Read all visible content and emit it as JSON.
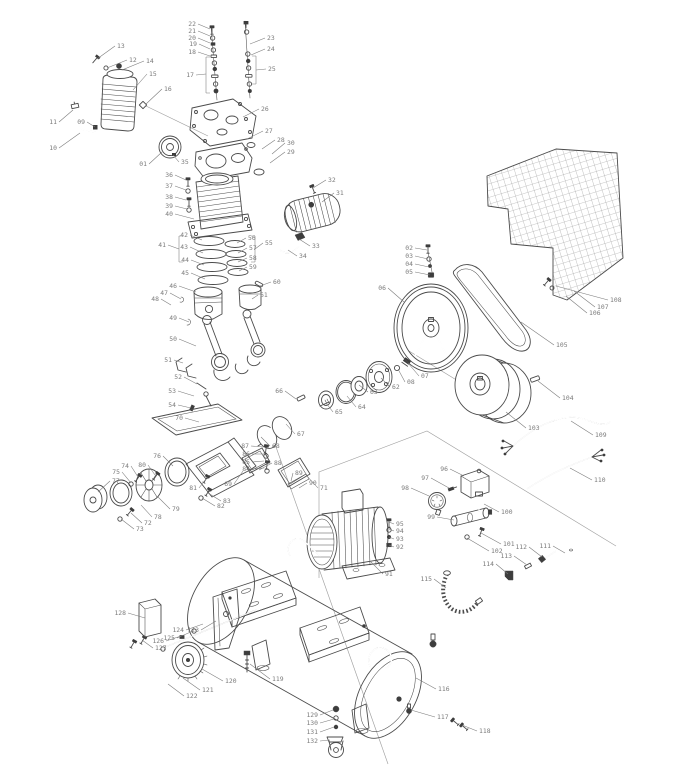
{
  "canvas": {
    "width": 686,
    "height": 768
  },
  "diagram": {
    "type": "exploded-parts-diagram",
    "colors": {
      "line": "#4b4b4b",
      "label": "#7a7a7a",
      "construction": "#a0a0a0",
      "dark": "#3d3d3d",
      "background": "#ffffff"
    },
    "callouts": [
      {
        "n": "01",
        "lx": 147,
        "ly": 164,
        "tx": 162,
        "ty": 152
      },
      {
        "n": "02",
        "lx": 413,
        "ly": 248,
        "tx": 427,
        "ty": 250
      },
      {
        "n": "03",
        "lx": 413,
        "ly": 256,
        "tx": 428,
        "ty": 259
      },
      {
        "n": "04",
        "lx": 413,
        "ly": 264,
        "tx": 429,
        "ty": 267
      },
      {
        "n": "05",
        "lx": 413,
        "ly": 272,
        "tx": 430,
        "ty": 275
      },
      {
        "n": "06",
        "lx": 386,
        "ly": 288,
        "tx": 404,
        "ty": 302
      },
      {
        "n": "07",
        "lx": 421,
        "ly": 376,
        "tx": 408,
        "ty": 363
      },
      {
        "n": "08",
        "lx": 407,
        "ly": 382,
        "tx": 398,
        "ty": 369
      },
      {
        "n": "09",
        "lx": 85,
        "ly": 122,
        "tx": 95,
        "ty": 127
      },
      {
        "n": "10",
        "lx": 57,
        "ly": 148,
        "tx": 80,
        "ty": 133
      },
      {
        "n": "11",
        "lx": 57,
        "ly": 122,
        "tx": 73,
        "ty": 110
      },
      {
        "n": "12",
        "lx": 129,
        "ly": 60,
        "tx": 107,
        "ty": 68
      },
      {
        "n": "13",
        "lx": 117,
        "ly": 46,
        "tx": 97,
        "ty": 59
      },
      {
        "n": "14",
        "lx": 146,
        "ly": 61,
        "tx": 122,
        "ty": 70
      },
      {
        "n": "15",
        "lx": 149,
        "ly": 74,
        "tx": 133,
        "ty": 90
      },
      {
        "n": "16",
        "lx": 164,
        "ly": 89,
        "tx": 146,
        "ty": 104
      },
      {
        "n": "17",
        "lx": 194,
        "ly": 75,
        "tx": 206,
        "ty": 74
      },
      {
        "n": "18",
        "lx": 196,
        "ly": 52,
        "tx": 210,
        "ty": 56
      },
      {
        "n": "19",
        "lx": 197,
        "ly": 44,
        "tx": 210,
        "ty": 49
      },
      {
        "n": "20",
        "lx": 196,
        "ly": 38,
        "tx": 210,
        "ty": 43
      },
      {
        "n": "21",
        "lx": 196,
        "ly": 31,
        "tx": 210,
        "ty": 36
      },
      {
        "n": "22",
        "lx": 196,
        "ly": 24,
        "tx": 210,
        "ty": 29
      },
      {
        "n": "23",
        "lx": 267,
        "ly": 38,
        "tx": 250,
        "ty": 44
      },
      {
        "n": "24",
        "lx": 267,
        "ly": 49,
        "tx": 251,
        "ty": 55
      },
      {
        "n": "25",
        "lx": 268,
        "ly": 69,
        "tx": 256,
        "ty": 70
      },
      {
        "n": "26",
        "lx": 261,
        "ly": 109,
        "tx": 243,
        "ty": 117
      },
      {
        "n": "27",
        "lx": 265,
        "ly": 131,
        "tx": 247,
        "ty": 139
      },
      {
        "n": "28",
        "lx": 277,
        "ly": 140,
        "tx": 262,
        "ty": 149
      },
      {
        "n": "29",
        "lx": 287,
        "ly": 152,
        "tx": 270,
        "ty": 163
      },
      {
        "n": "30",
        "lx": 287,
        "ly": 143,
        "tx": 272,
        "ty": 154
      },
      {
        "n": "31",
        "lx": 336,
        "ly": 193,
        "tx": 322,
        "ty": 202
      },
      {
        "n": "32",
        "lx": 328,
        "ly": 180,
        "tx": 313,
        "ty": 188
      },
      {
        "n": "33",
        "lx": 312,
        "ly": 246,
        "tx": 299,
        "ty": 239
      },
      {
        "n": "34",
        "lx": 299,
        "ly": 256,
        "tx": 288,
        "ty": 250
      },
      {
        "n": "35",
        "lx": 181,
        "ly": 162,
        "tx": 173,
        "ty": 155
      },
      {
        "n": "36",
        "lx": 173,
        "ly": 175,
        "tx": 186,
        "ty": 180
      },
      {
        "n": "37",
        "lx": 173,
        "ly": 186,
        "tx": 186,
        "ty": 190
      },
      {
        "n": "38",
        "lx": 173,
        "ly": 197,
        "tx": 186,
        "ty": 200
      },
      {
        "n": "39",
        "lx": 173,
        "ly": 206,
        "tx": 187,
        "ty": 209
      },
      {
        "n": "40",
        "lx": 173,
        "ly": 214,
        "tx": 194,
        "ty": 219
      },
      {
        "n": "41",
        "lx": 166,
        "ly": 245,
        "tx": 179,
        "ty": 249
      },
      {
        "n": "42",
        "lx": 188,
        "ly": 235,
        "tx": 202,
        "ty": 240
      },
      {
        "n": "43",
        "lx": 188,
        "ly": 247,
        "tx": 203,
        "ty": 253
      },
      {
        "n": "44",
        "lx": 189,
        "ly": 260,
        "tx": 204,
        "ty": 265
      },
      {
        "n": "45",
        "lx": 189,
        "ly": 273,
        "tx": 205,
        "ty": 279
      },
      {
        "n": "46",
        "lx": 177,
        "ly": 286,
        "tx": 196,
        "ty": 292
      },
      {
        "n": "47",
        "lx": 168,
        "ly": 293,
        "tx": 181,
        "ty": 299
      },
      {
        "n": "48",
        "lx": 159,
        "ly": 299,
        "tx": 171,
        "ty": 305
      },
      {
        "n": "49",
        "lx": 177,
        "ly": 318,
        "tx": 189,
        "ty": 322
      },
      {
        "n": "50",
        "lx": 177,
        "ly": 339,
        "tx": 196,
        "ty": 346
      },
      {
        "n": "51",
        "lx": 172,
        "ly": 360,
        "tx": 183,
        "ty": 363
      },
      {
        "n": "52",
        "lx": 182,
        "ly": 377,
        "tx": 197,
        "ty": 384
      },
      {
        "n": "53",
        "lx": 176,
        "ly": 391,
        "tx": 194,
        "ty": 396
      },
      {
        "n": "54",
        "lx": 176,
        "ly": 405,
        "tx": 191,
        "ty": 408
      },
      {
        "n": "55",
        "lx": 265,
        "ly": 243,
        "tx": 255,
        "ty": 249
      },
      {
        "n": "56",
        "lx": 248,
        "ly": 238,
        "tx": 237,
        "ty": 243
      },
      {
        "n": "57",
        "lx": 249,
        "ly": 248,
        "tx": 238,
        "ty": 253
      },
      {
        "n": "58",
        "lx": 249,
        "ly": 258,
        "tx": 238,
        "ty": 262
      },
      {
        "n": "59",
        "lx": 249,
        "ly": 267,
        "tx": 239,
        "ty": 271
      },
      {
        "n": "60",
        "lx": 273,
        "ly": 282,
        "tx": 260,
        "ty": 286
      },
      {
        "n": "61",
        "lx": 260,
        "ly": 295,
        "tx": 252,
        "ty": 299
      },
      {
        "n": "62",
        "lx": 392,
        "ly": 387,
        "tx": 381,
        "ty": 378
      },
      {
        "n": "63",
        "lx": 370,
        "ly": 392,
        "tx": 359,
        "ty": 385
      },
      {
        "n": "64",
        "lx": 358,
        "ly": 407,
        "tx": 347,
        "ty": 396
      },
      {
        "n": "65",
        "lx": 335,
        "ly": 412,
        "tx": 326,
        "ty": 403
      },
      {
        "n": "66",
        "lx": 283,
        "ly": 391,
        "tx": 296,
        "ty": 399
      },
      {
        "n": "67",
        "lx": 297,
        "ly": 434,
        "tx": 286,
        "ty": 424
      },
      {
        "n": "68",
        "lx": 272,
        "ly": 446,
        "tx": 261,
        "ty": 437
      },
      {
        "n": "69",
        "lx": 232,
        "ly": 484,
        "tx": 243,
        "ty": 471
      },
      {
        "n": "70",
        "lx": 183,
        "ly": 418,
        "tx": 199,
        "ty": 422
      },
      {
        "n": "71",
        "lx": 320,
        "ly": 488,
        "tx": 306,
        "ty": 475
      },
      {
        "n": "72",
        "lx": 144,
        "ly": 523,
        "tx": 131,
        "ty": 513
      },
      {
        "n": "73",
        "lx": 136,
        "ly": 529,
        "tx": 121,
        "ty": 519
      },
      {
        "n": "74",
        "lx": 129,
        "ly": 466,
        "tx": 138,
        "ty": 477
      },
      {
        "n": "75",
        "lx": 120,
        "ly": 472,
        "tx": 131,
        "ty": 483
      },
      {
        "n": "76",
        "lx": 161,
        "ly": 456,
        "tx": 173,
        "ty": 466
      },
      {
        "n": "77",
        "lx": 112,
        "ly": 481,
        "tx": 98,
        "ty": 492
      },
      {
        "n": "78",
        "lx": 154,
        "ly": 517,
        "tx": 141,
        "ty": 505
      },
      {
        "n": "79",
        "lx": 172,
        "ly": 509,
        "tx": 158,
        "ty": 497
      },
      {
        "n": "80",
        "lx": 146,
        "ly": 465,
        "tx": 155,
        "ty": 475
      },
      {
        "n": "81",
        "lx": 197,
        "ly": 488,
        "tx": 206,
        "ty": 479
      },
      {
        "n": "82",
        "lx": 217,
        "ly": 506,
        "tx": 202,
        "ty": 498
      },
      {
        "n": "83",
        "lx": 223,
        "ly": 501,
        "tx": 208,
        "ty": 493
      },
      {
        "n": "84",
        "lx": 250,
        "ly": 469,
        "tx": 264,
        "ty": 468
      },
      {
        "n": "85",
        "lx": 250,
        "ly": 462,
        "tx": 264,
        "ty": 461
      },
      {
        "n": "86",
        "lx": 250,
        "ly": 454,
        "tx": 264,
        "ty": 454
      },
      {
        "n": "87",
        "lx": 249,
        "ly": 446,
        "tx": 264,
        "ty": 447
      },
      {
        "n": "88",
        "lx": 274,
        "ly": 463,
        "tx": 259,
        "ty": 470
      },
      {
        "n": "89",
        "lx": 295,
        "ly": 473,
        "tx": 291,
        "ty": 481
      },
      {
        "n": "90",
        "lx": 309,
        "ly": 483,
        "tx": 299,
        "ty": 488
      },
      {
        "n": "91",
        "lx": 385,
        "ly": 574,
        "tx": 371,
        "ty": 562
      },
      {
        "n": "92",
        "lx": 396,
        "ly": 547,
        "tx": 389,
        "ty": 545
      },
      {
        "n": "93",
        "lx": 396,
        "ly": 539,
        "tx": 389,
        "ty": 537
      },
      {
        "n": "94",
        "lx": 396,
        "ly": 531,
        "tx": 389,
        "ty": 529
      },
      {
        "n": "95",
        "lx": 396,
        "ly": 524,
        "tx": 389,
        "ty": 522
      },
      {
        "n": "96",
        "lx": 448,
        "ly": 469,
        "tx": 464,
        "ty": 476
      },
      {
        "n": "97",
        "lx": 429,
        "ly": 478,
        "tx": 449,
        "ty": 488
      },
      {
        "n": "98",
        "lx": 409,
        "ly": 488,
        "tx": 429,
        "ty": 496
      },
      {
        "n": "99",
        "lx": 435,
        "ly": 517,
        "tx": 454,
        "ty": 520
      },
      {
        "n": "100",
        "lx": 501,
        "ly": 512,
        "tx": 484,
        "ty": 504
      },
      {
        "n": "101",
        "lx": 503,
        "ly": 544,
        "tx": 481,
        "ty": 533
      },
      {
        "n": "102",
        "lx": 491,
        "ly": 551,
        "tx": 467,
        "ty": 538
      },
      {
        "n": "103",
        "lx": 528,
        "ly": 428,
        "tx": 506,
        "ty": 412
      },
      {
        "n": "104",
        "lx": 562,
        "ly": 398,
        "tx": 538,
        "ty": 381
      },
      {
        "n": "105",
        "lx": 556,
        "ly": 345,
        "tx": 521,
        "ty": 322
      },
      {
        "n": "106",
        "lx": 589,
        "ly": 313,
        "tx": 566,
        "ty": 296
      },
      {
        "n": "107",
        "lx": 597,
        "ly": 307,
        "tx": 574,
        "ty": 291
      },
      {
        "n": "108",
        "lx": 610,
        "ly": 300,
        "tx": 556,
        "ty": 286
      },
      {
        "n": "109",
        "lx": 595,
        "ly": 435,
        "tx": 571,
        "ty": 421
      },
      {
        "n": "110",
        "lx": 594,
        "ly": 480,
        "tx": 570,
        "ty": 468
      },
      {
        "n": "111",
        "lx": 551,
        "ly": 546,
        "tx": 565,
        "ty": 553
      },
      {
        "n": "112",
        "lx": 527,
        "ly": 547,
        "tx": 542,
        "ty": 557
      },
      {
        "n": "113",
        "lx": 512,
        "ly": 556,
        "tx": 527,
        "ty": 565
      },
      {
        "n": "114",
        "lx": 494,
        "ly": 564,
        "tx": 508,
        "ty": 574
      },
      {
        "n": "115",
        "lx": 432,
        "ly": 579,
        "tx": 446,
        "ty": 588
      },
      {
        "n": "116",
        "lx": 438,
        "ly": 689,
        "tx": 416,
        "ty": 678
      },
      {
        "n": "117",
        "lx": 437,
        "ly": 717,
        "tx": 411,
        "ty": 710
      },
      {
        "n": "118",
        "lx": 479,
        "ly": 731,
        "tx": 462,
        "ty": 725
      },
      {
        "n": "119",
        "lx": 272,
        "ly": 679,
        "tx": 250,
        "ty": 664
      },
      {
        "n": "120",
        "lx": 225,
        "ly": 681,
        "tx": 202,
        "ty": 669
      },
      {
        "n": "121",
        "lx": 202,
        "ly": 690,
        "tx": 183,
        "ty": 678
      },
      {
        "n": "122",
        "lx": 186,
        "ly": 696,
        "tx": 168,
        "ty": 684
      },
      {
        "n": "123",
        "lx": 199,
        "ly": 630,
        "tx": 216,
        "ty": 621
      },
      {
        "n": "124",
        "lx": 184,
        "ly": 630,
        "tx": 203,
        "ty": 624
      },
      {
        "n": "125",
        "lx": 175,
        "ly": 638,
        "tx": 193,
        "ty": 631
      },
      {
        "n": "126",
        "lx": 164,
        "ly": 641,
        "tx": 181,
        "ty": 636
      },
      {
        "n": "127",
        "lx": 155,
        "ly": 648,
        "tx": 142,
        "ty": 640
      },
      {
        "n": "128",
        "lx": 126,
        "ly": 613,
        "tx": 145,
        "ty": 618
      },
      {
        "n": "129",
        "lx": 318,
        "ly": 715,
        "tx": 333,
        "ty": 710
      },
      {
        "n": "130",
        "lx": 318,
        "ly": 723,
        "tx": 334,
        "ty": 719
      },
      {
        "n": "131",
        "lx": 318,
        "ly": 732,
        "tx": 334,
        "ty": 727
      },
      {
        "n": "132",
        "lx": 318,
        "ly": 741,
        "tx": 330,
        "ty": 740
      }
    ]
  }
}
